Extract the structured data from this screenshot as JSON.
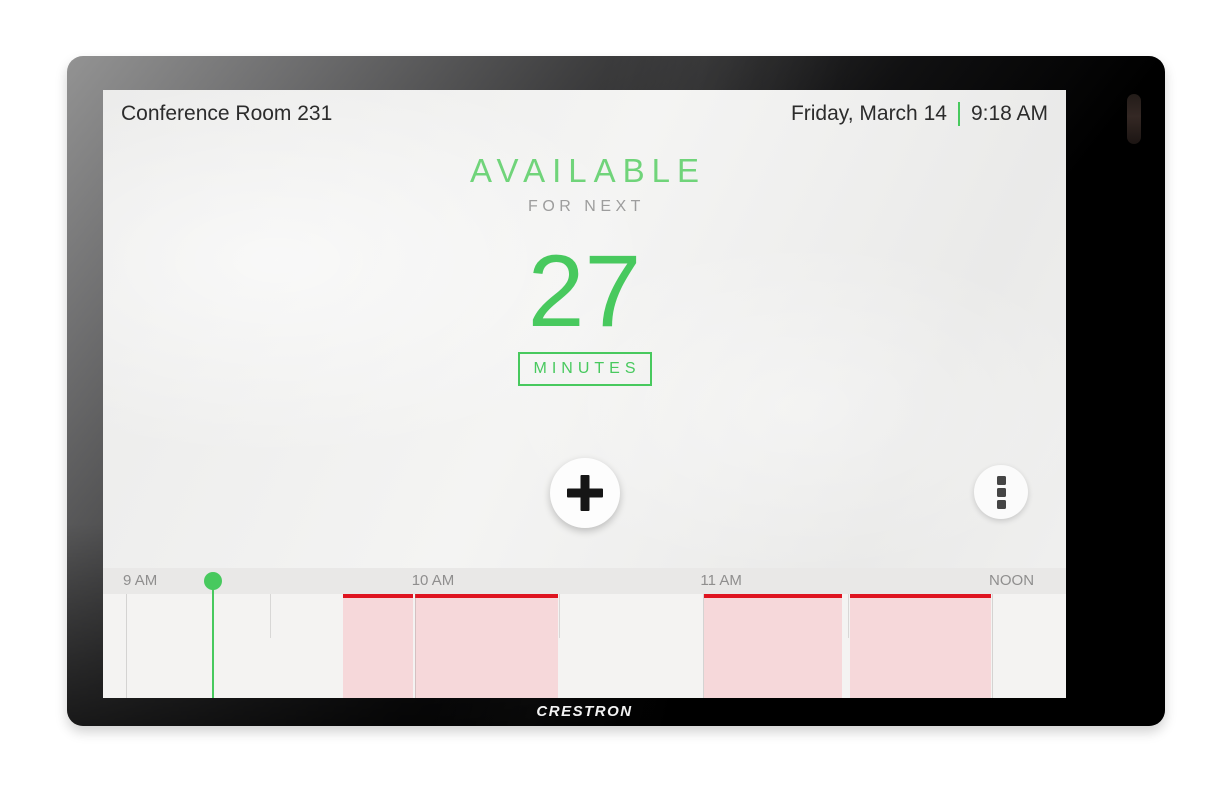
{
  "device": {
    "brand_logo": "CRESTRON"
  },
  "header": {
    "room_name": "Conference Room 231",
    "date": "Friday, March 14",
    "time": "9:18 AM"
  },
  "status": {
    "state": "AVAILABLE",
    "subtitle": "FOR NEXT",
    "minutes_value": "27",
    "minutes_label": "MINUTES"
  },
  "icons": {
    "add": "plus-icon",
    "more": "vertical-ellipsis-icon",
    "camera": "camera-sensor"
  },
  "colors": {
    "green_light": "#70d47a",
    "green": "#48c95e",
    "busy_red": "#df1420",
    "busy_fill": "#f6d8da",
    "text_dark": "#2c2c2c",
    "text_gray": "#9d9d9d",
    "label_gray": "#8f8e8e",
    "strip_bg": "#e9e8e7",
    "chart_bg": "#f4f3f2"
  },
  "timeline": {
    "axis_start": "9 AM",
    "axis_end": "NOON",
    "hours": [
      {
        "label": "9 AM",
        "pos_pct": 2.39
      },
      {
        "label": "10 AM",
        "pos_pct": 32.37
      },
      {
        "label": "11 AM",
        "pos_pct": 62.35
      },
      {
        "label": "NOON",
        "pos_pct": 92.32
      }
    ],
    "half_hour_ticks_pct": [
      17.38,
      47.35,
      77.33
    ],
    "current_time": {
      "label": "9:18 AM",
      "pos_pct": 11.38
    },
    "busy_blocks": [
      {
        "start": "9:45 AM",
        "end": "10:00 AM",
        "left_pct": 24.92,
        "width_pct": 7.27
      },
      {
        "start": "10:00 AM",
        "end": "10:30 AM",
        "left_pct": 32.45,
        "width_pct": 14.8
      },
      {
        "start": "11:00 AM",
        "end": "11:30 AM",
        "left_pct": 62.46,
        "width_pct": 14.33
      },
      {
        "start": "11:30 AM",
        "end": "12:00 PM",
        "left_pct": 77.62,
        "width_pct": 14.59
      }
    ]
  }
}
